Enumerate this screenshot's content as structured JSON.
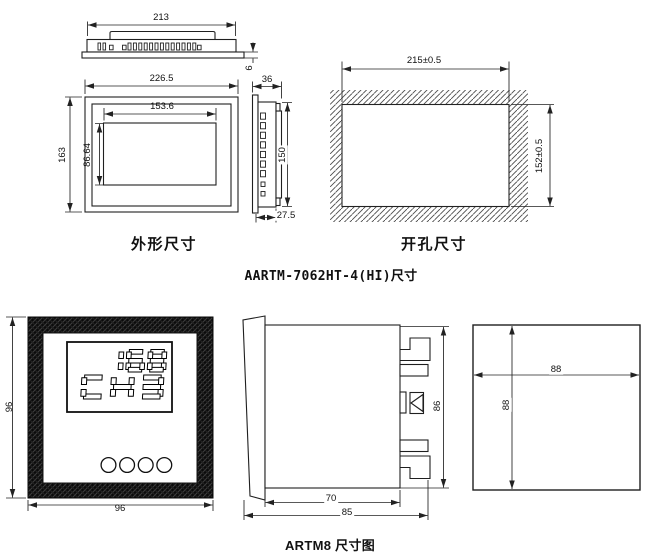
{
  "titles": {
    "top_caption": "AARTM-7062HT-4(HI)尺寸",
    "bottom_caption": "ARTM8 尺寸图",
    "outline_label": "外形尺寸",
    "cutout_label": "开孔尺寸"
  },
  "aartm7062": {
    "top_view": {
      "width": "213",
      "bezel_thickness": "6"
    },
    "front_view": {
      "width": "226.5",
      "height": "163",
      "display_width": "153.6",
      "display_height": "86.64"
    },
    "side_view": {
      "depth": "36",
      "height": "150",
      "rear_depth": "27.5"
    },
    "cutout_view": {
      "width": "215±0.5",
      "height": "152±0.5"
    }
  },
  "artm8": {
    "front_view": {
      "width": "96",
      "height": "96",
      "display_line1": "168",
      "display_line2": "CH3",
      "button_count": 4
    },
    "side_view": {
      "height": "86",
      "body_depth": "70",
      "total_depth": "85"
    },
    "rear_view": {
      "width": "88",
      "height": "88"
    }
  },
  "colors": {
    "line": "#222222",
    "hatch": "#4a4a4a",
    "frame_dark": "#0b0b0b"
  }
}
